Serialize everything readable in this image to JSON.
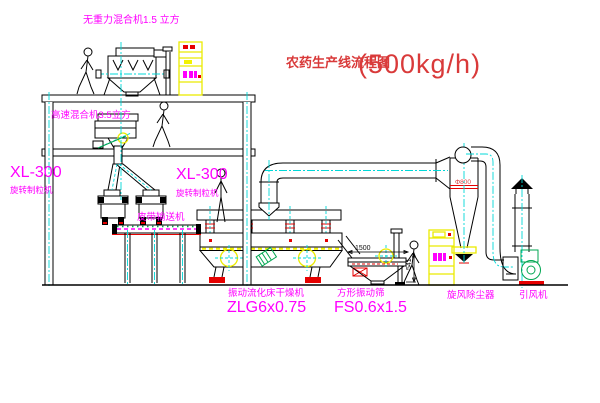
{
  "title": {
    "name": "农药生产线流程图",
    "capacity": "(500kg/h)"
  },
  "labels": {
    "gravity_mixer": "无重力混合机1.5 立方",
    "high_speed_mixer": "高速混合机3.5立方",
    "granulator_model_left": "XL-300",
    "granulator_name_left": "旋转制粒机",
    "granulator_model_right": "XL-300",
    "granulator_name_right": "旋转制粒机",
    "belt_conveyor": "皮带输送机",
    "dryer_name": "振动流化床干燥机",
    "dryer_model": "ZLG6x0.75",
    "sieve_name": "方形振动筛",
    "sieve_model": "FS0.6x1.5",
    "cyclone_name": "旋风除尘器",
    "fan_name": "引风机"
  },
  "dimensions": {
    "sieve_length": "1500",
    "sieve_height": "541",
    "cyclone_diameter": "Φ800"
  },
  "colors": {
    "line": "#000000",
    "centerline": "#00d8d8",
    "label_magenta": "#ff00ff",
    "title_red": "#d93a3a",
    "cabinet_yellow": "#f2f200",
    "detail_red": "#e60000",
    "machine_green": "#00a651"
  }
}
